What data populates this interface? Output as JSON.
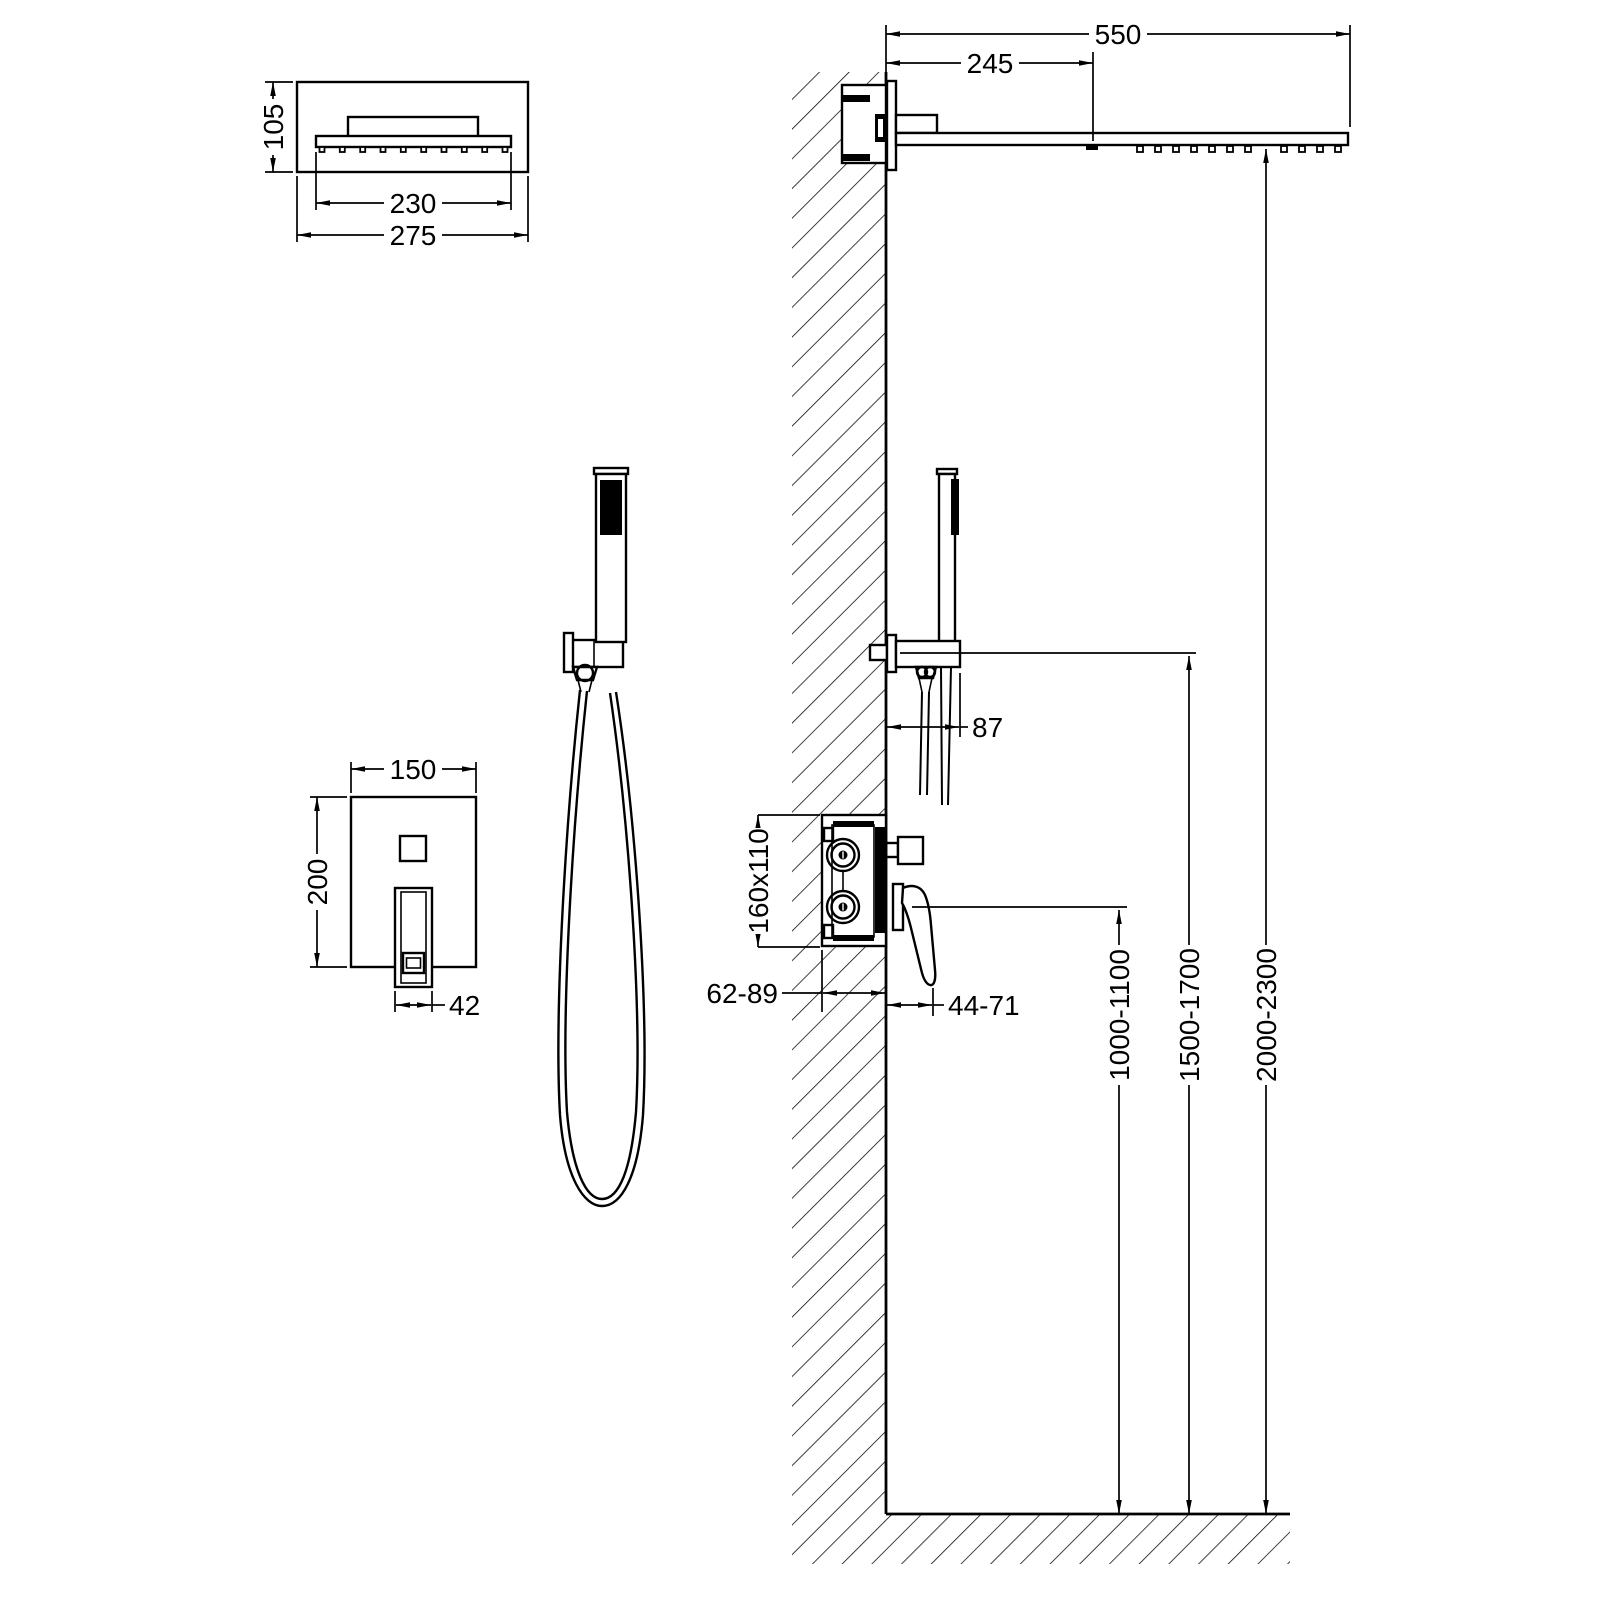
{
  "colors": {
    "line": "#000000",
    "background": "#ffffff"
  },
  "views": {
    "head_front": {
      "height": "105",
      "spray_width": "230",
      "width": "275"
    },
    "mixer_front": {
      "width": "150",
      "height": "200",
      "lever_width": "42"
    },
    "side": {
      "arm_length": "550",
      "spray_offset": "245",
      "handset_offset": "87",
      "mixer_box": "160x110",
      "recess_depth": "62-89",
      "lever_reach": "44-71",
      "mixer_height": "1000-1100",
      "holder_height": "1500-1700",
      "head_height": "2000-2300"
    }
  }
}
